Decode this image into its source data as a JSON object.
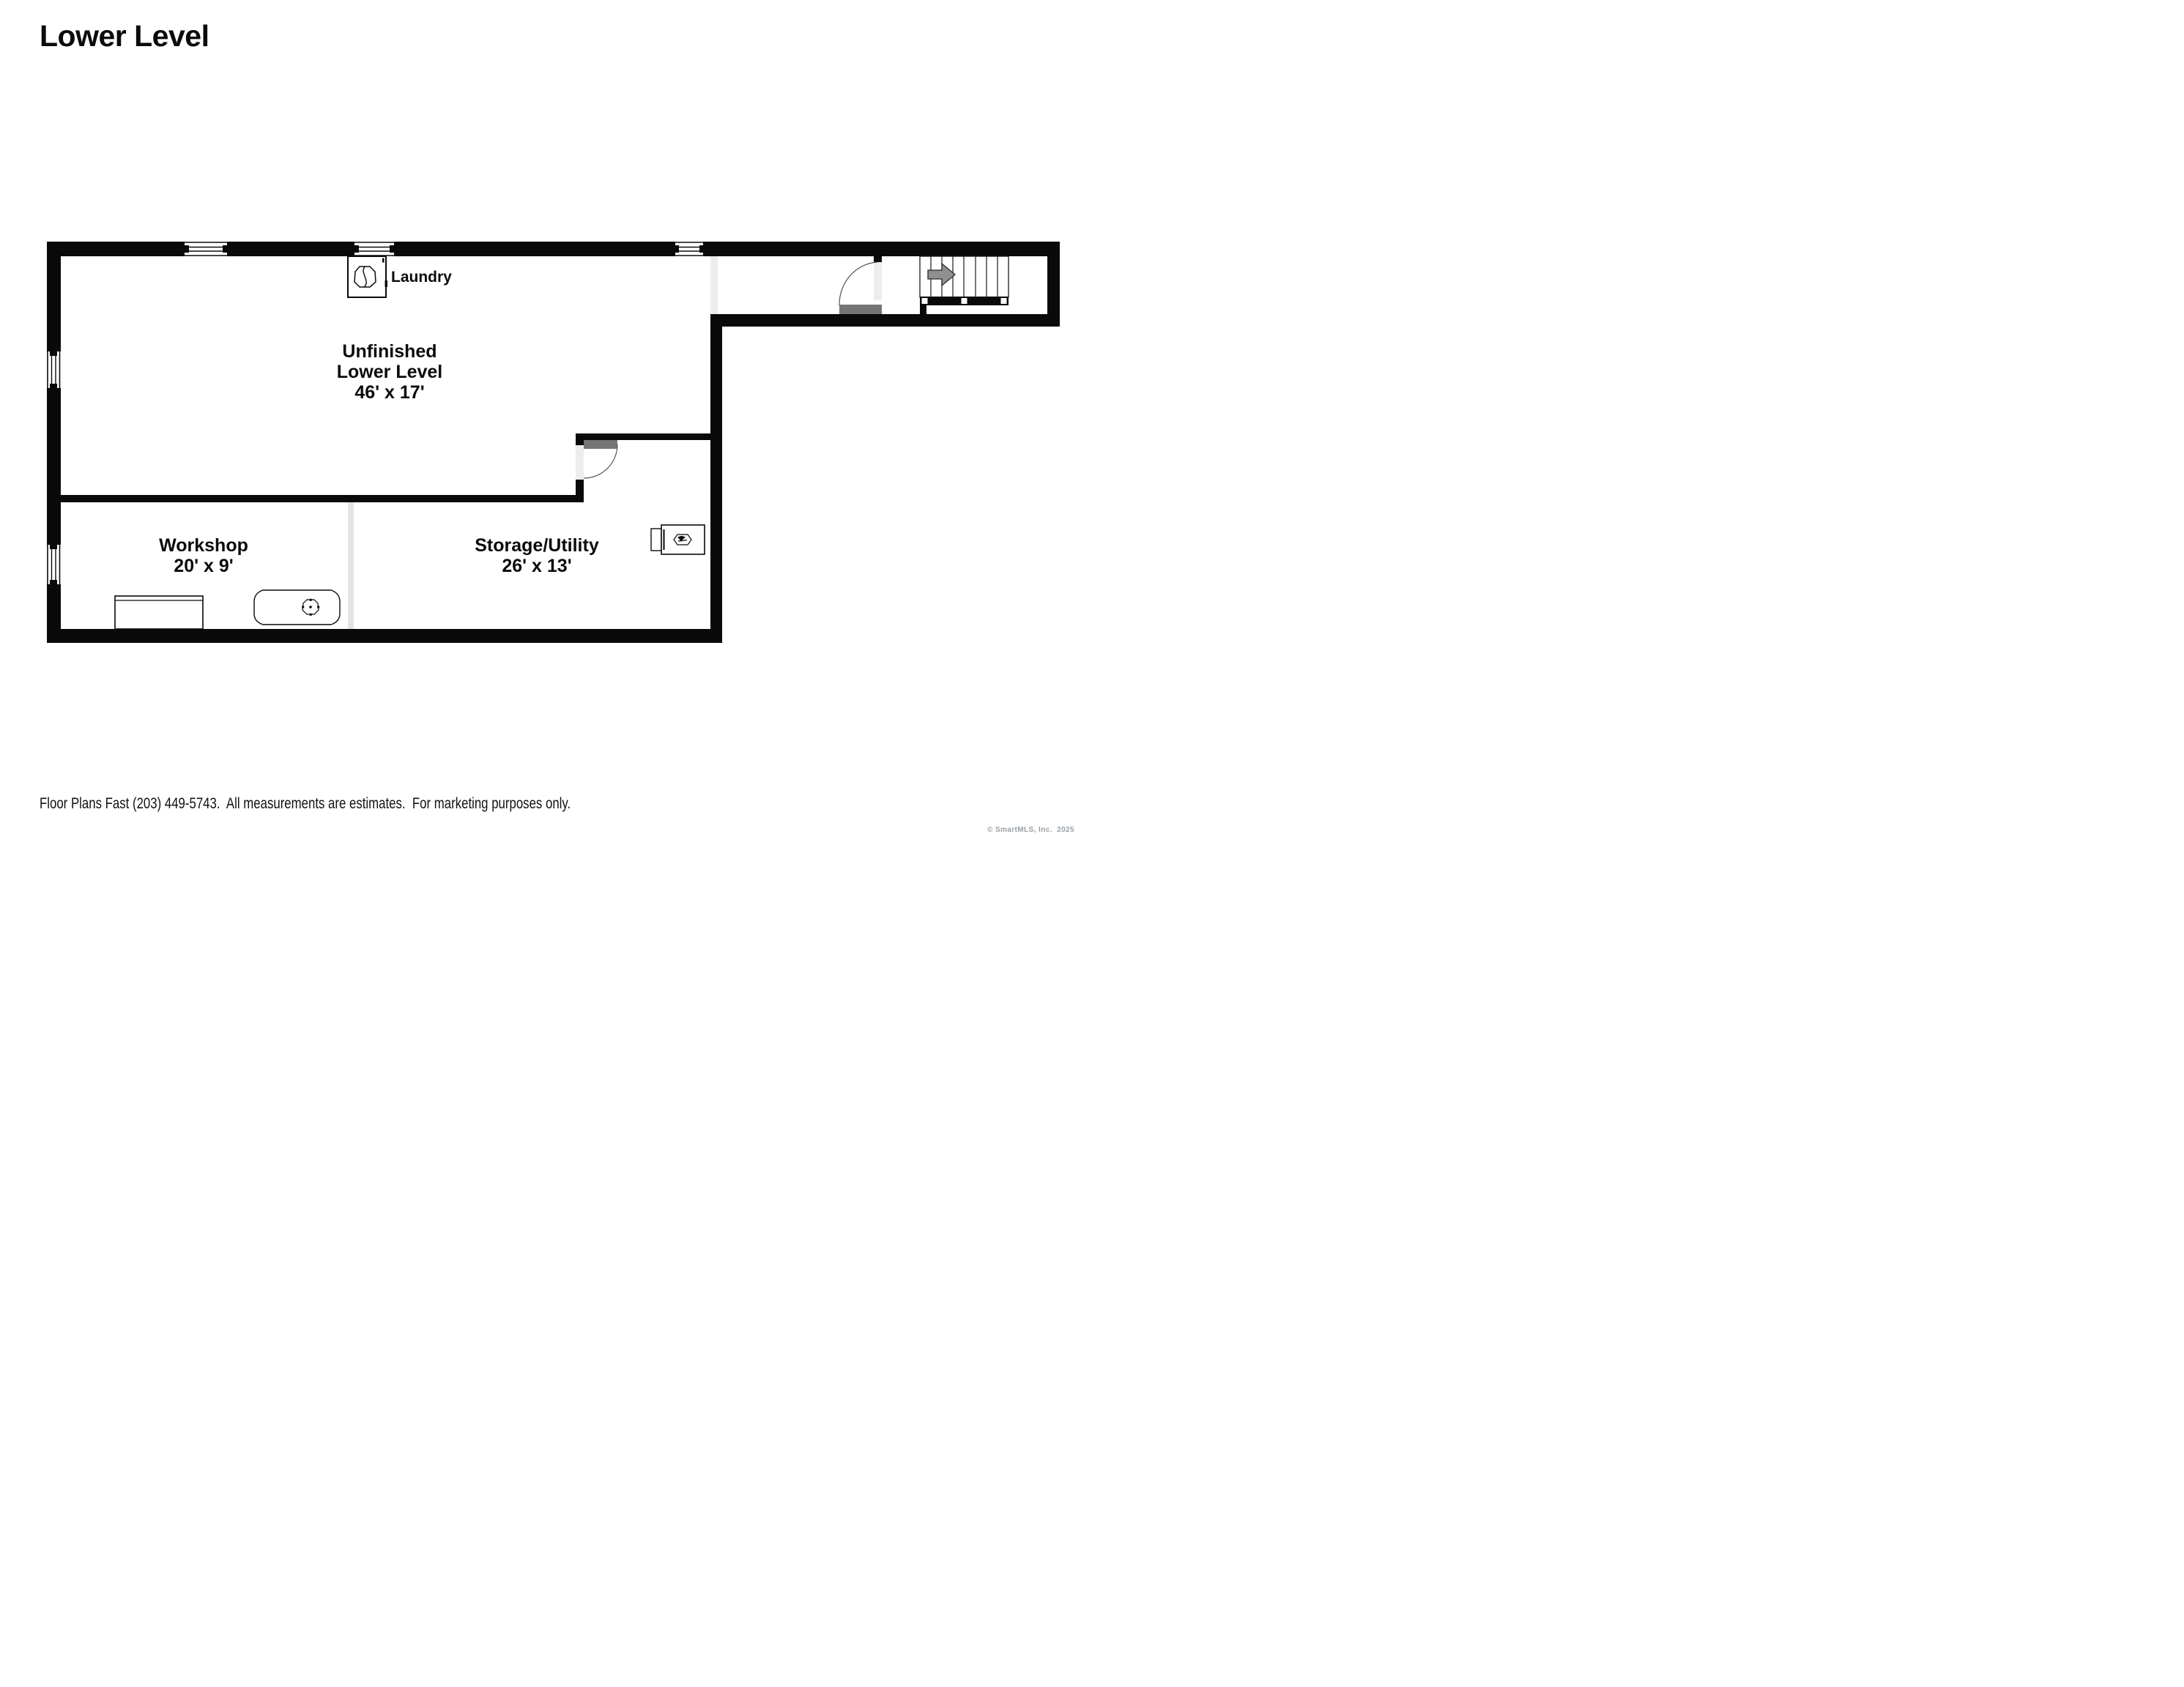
{
  "title": "Lower Level",
  "floor_plan": {
    "rooms": {
      "main": {
        "line1": "Unfinished",
        "line2": "Lower Level",
        "dims": "46' x 17'"
      },
      "workshop": {
        "name": "Workshop",
        "dims": "20' x 9'"
      },
      "storage": {
        "name": "Storage/Utility",
        "dims": "26' x 13'"
      },
      "laundry_label": "Laundry"
    },
    "icons": {
      "washer": "washing-machine-icon",
      "furnace": "furnace-icon",
      "tub": "utility-tub-icon",
      "workbench": "workbench",
      "stairs": "staircase",
      "stairs_arrow": "up-direction-arrow-icon"
    },
    "colors": {
      "wall": "#0a0a0a",
      "door_leaf": "#757575",
      "opening": "#ededed",
      "partition": "#e4e4e4",
      "arrow_fill": "#8f8f8f"
    }
  },
  "footer": "Floor Plans Fast (203) 449-5743.  All measurements are estimates.  For marketing purposes only.",
  "watermark": "© SmartMLS, Inc.  2025"
}
